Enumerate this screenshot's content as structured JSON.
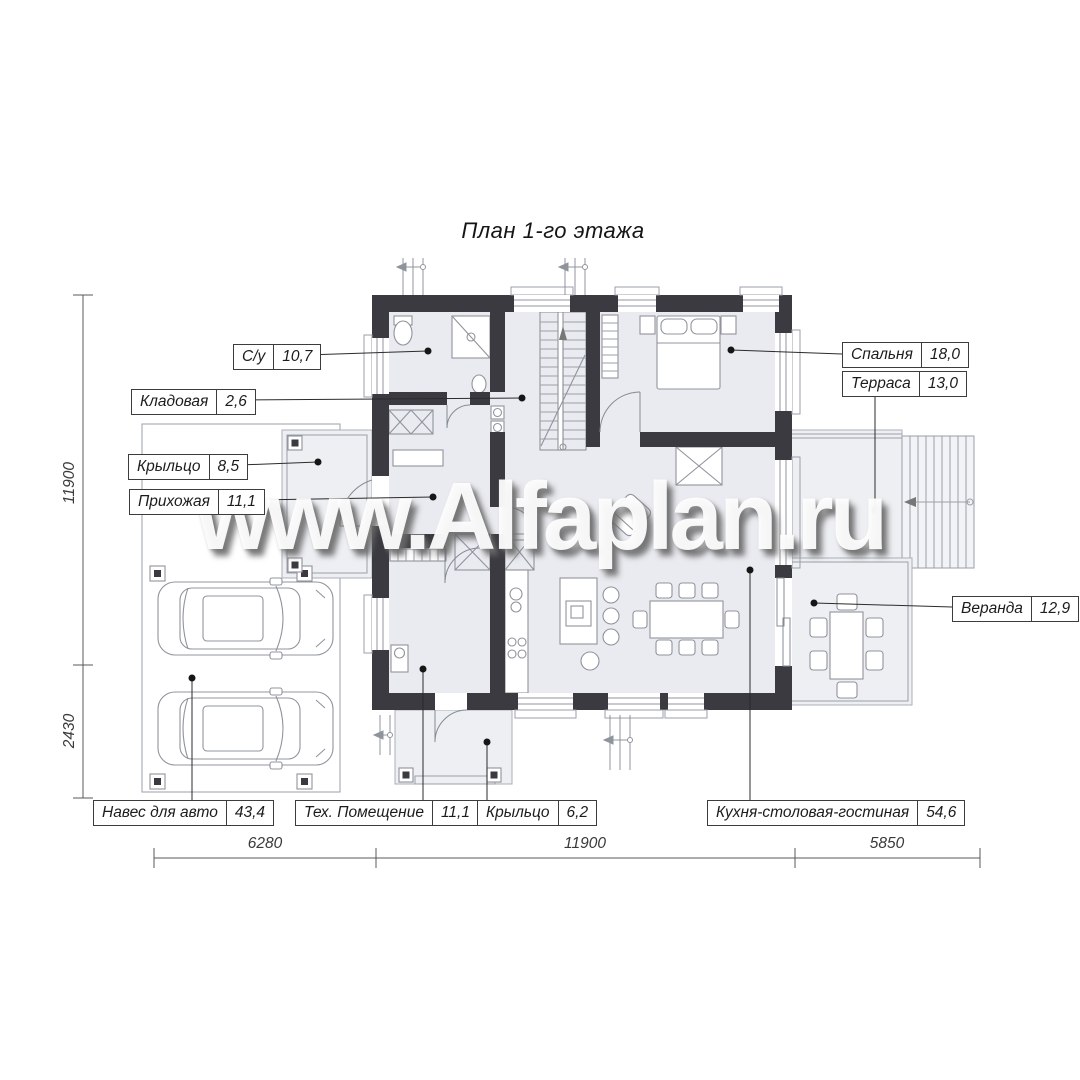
{
  "title": "План 1-го этажа",
  "watermark": "www.Alfaplan.ru",
  "room_labels": [
    {
      "name": "С/у",
      "area": "10,7"
    },
    {
      "name": "Кладовая",
      "area": "2,6"
    },
    {
      "name": "Крыльцо",
      "area": "8,5"
    },
    {
      "name": "Прихожая",
      "area": "11,1"
    },
    {
      "name": "Спальня",
      "area": "18,0"
    },
    {
      "name": "Терраса",
      "area": "13,0"
    },
    {
      "name": "Веранда",
      "area": "12,9"
    },
    {
      "name": "Навес для авто",
      "area": "43,4"
    },
    {
      "name": "Тех. Помещение",
      "area": "11,1"
    },
    {
      "name": "Крыльцо",
      "area": "6,2"
    },
    {
      "name": "Кухня-столовая-гостиная",
      "area": "54,6"
    }
  ],
  "dimensions": {
    "left_vertical": [
      "11900",
      "2430"
    ],
    "bottom_horizontal": [
      "6280",
      "11900",
      "5850"
    ]
  },
  "colors": {
    "wall": "#3a3a40",
    "room_fill": "#e9ebf0",
    "platform_fill": "#edeff3",
    "leader": "#2b2b2b",
    "dimension": "#5a5a5a",
    "watermark_shadow": "#696969"
  }
}
